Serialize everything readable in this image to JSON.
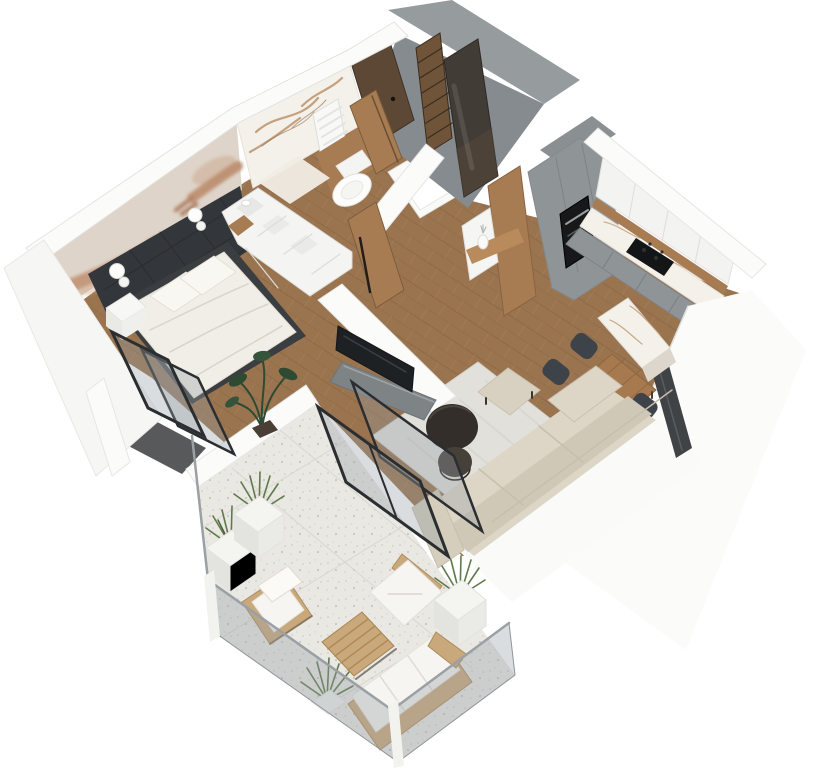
{
  "scene": {
    "title": "3D isometric apartment floor plan render",
    "view": "top-down isometric cutaway",
    "background": "#ffffff"
  },
  "palette": {
    "background": "#ffffff",
    "wood_floor": "#9a744f",
    "wood_floor_dark": "#85603f",
    "wood_floor_light": "#aa825c",
    "terrace_floor": "#eae8e3",
    "balcony_floor": "#57595b",
    "wall_white": "#fbfbfa",
    "wall_outer": "#f6f6f4",
    "wall_grey": "#969b9e",
    "wall_grey_dark": "#868b8f",
    "accent_wall": "#33363a",
    "mural_plaster": "#ded4c9",
    "mural_skin": "#c29679",
    "marble_white": "#f4f0ea",
    "marble_vein": "#b3875a",
    "door_wood": "#a87c52",
    "entrance_door": "#5d4836",
    "mirror_dark": "#423c37",
    "shelf_wood": "#6f543a",
    "kitchen_grey": "#8f9497",
    "cabinet_white": "#f3f3f1",
    "appliance_black": "#17181a",
    "table_wood": "#a6794e",
    "chair_dark": "#3e434a",
    "tv_black": "#1e2124",
    "tv_cabinet": "#7e8386",
    "rug": "#e1e0db",
    "sofa": "#ddd6c6",
    "sofa_shade": "#cfc8b7",
    "pouf": "#d8d1c1",
    "coffee_table": "#332e29",
    "bed_frame": "#3b3e41",
    "bedding": "#f1eee7",
    "pillow": "#f9f7f2",
    "rattan": "#c9a87b",
    "cushion_white": "#f6f5f1",
    "plant_green": "#5f7a4a",
    "plant_dark": "#2f4a33",
    "glass_tint": "rgba(150,158,163,0.35)",
    "frame_black": "#2b2e30"
  },
  "rooms": {
    "bedroom": {
      "name": "Bedroom",
      "items": [
        "double bed",
        "pillows",
        "nightstand",
        "white wardrobe units",
        "Creation of Adam wall mural",
        "dark upholstered accent wall",
        "wall sconces",
        "potted plant",
        "balcony door"
      ]
    },
    "bathroom": {
      "name": "Bathroom",
      "items": [
        "marble feature wall",
        "towel radiator",
        "wall-hung toilet",
        "wood toilet panel",
        "bathtub",
        "wood door"
      ]
    },
    "hallway": {
      "name": "Entrance hall",
      "items": [
        "entrance door",
        "open shelving column",
        "mirrored sliding wardrobe",
        "console panel with shelf and vase",
        "wood door to bedroom"
      ]
    },
    "kitchen": {
      "name": "Kitchen",
      "items": [
        "tall grey units",
        "built-in oven",
        "white upper cabinets",
        "wood backsplash strip",
        "marble worktop",
        "induction hob",
        "grey base cabinets"
      ]
    },
    "dining": {
      "name": "Dining area",
      "items": [
        "marble peninsula",
        "wooden dining table",
        "four dark chairs"
      ]
    },
    "living": {
      "name": "Living room",
      "items": [
        "TV",
        "grey media cabinet",
        "area rug",
        "nesting coffee tables",
        "pouf",
        "corner sofa",
        "sliding glass doors",
        "dark window"
      ]
    },
    "balcony": {
      "name": "Bedroom balcony",
      "items": [
        "dark floor",
        "black framed glazing"
      ]
    },
    "terrace": {
      "name": "Terrace",
      "items": [
        "terrazzo tile floor",
        "glass balustrade",
        "white planters with grasses",
        "lounge chair",
        "armchair",
        "slatted coffee table",
        "outdoor sofa"
      ]
    }
  }
}
